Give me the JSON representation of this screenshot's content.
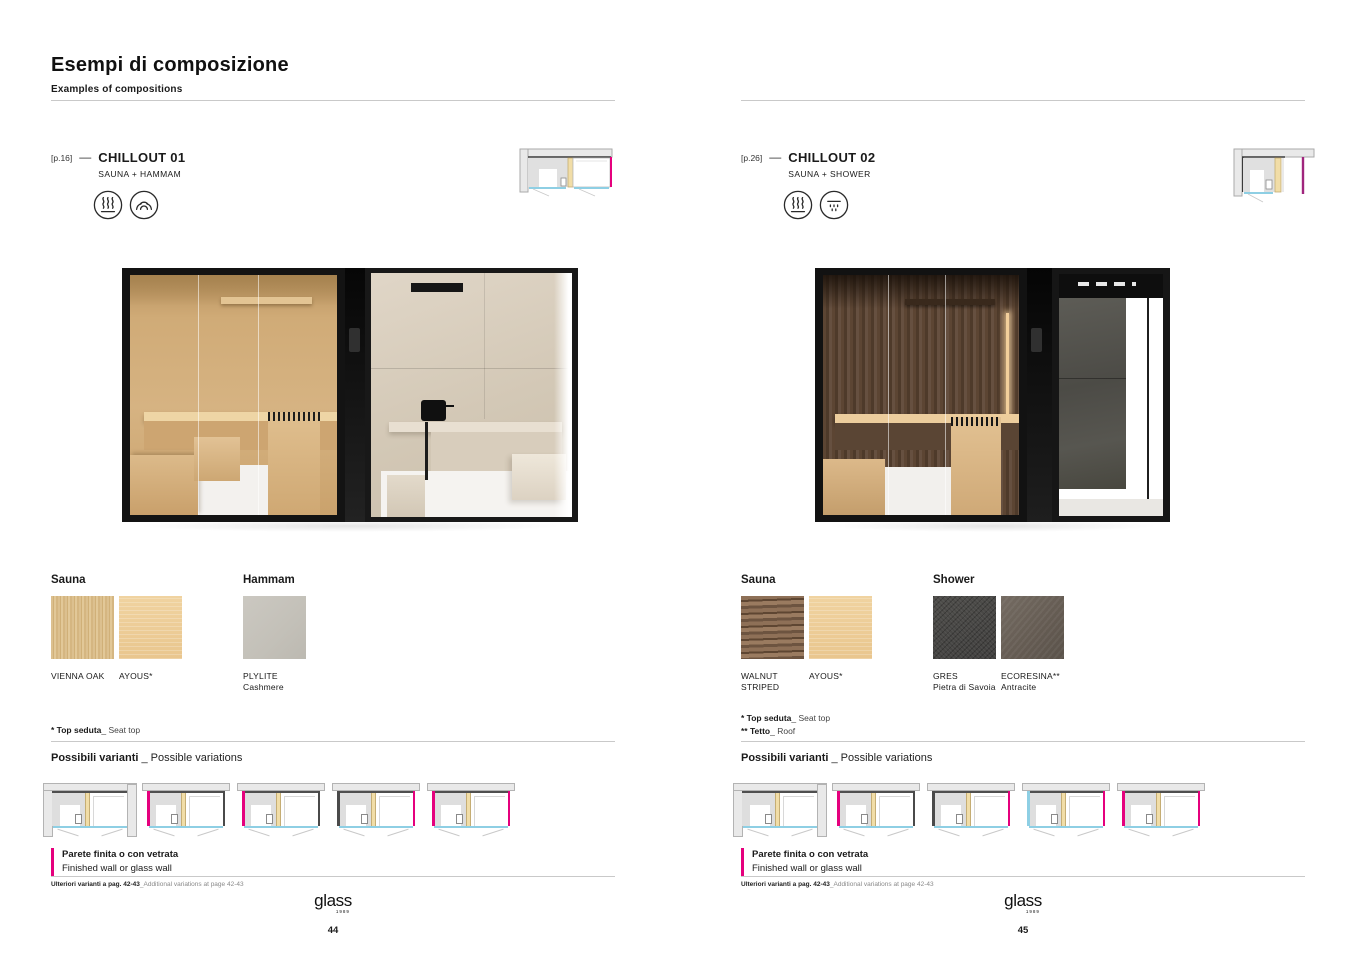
{
  "colors": {
    "accent_pink": "#e5007d",
    "glass_blue": "#8ecfe4",
    "wall_grey": "#e9e9e9",
    "text": "#1a1a1a"
  },
  "header": {
    "title": "Esempi di composizione",
    "subtitle": "Examples of compositions"
  },
  "pages": [
    {
      "page_ref": "[p.16]",
      "dash": "—",
      "product_name": "CHILLOUT 01",
      "product_type": "SAUNA + HAMMAM",
      "icons": [
        "sauna-heat-icon",
        "hammam-steam-icon"
      ],
      "materials": [
        {
          "group": "Sauna",
          "swatches": [
            {
              "name": "VIENNA OAK",
              "sub": "",
              "texture": "vienna-oak"
            },
            {
              "name": "AYOUS*",
              "sub": "",
              "texture": "ayous"
            }
          ]
        },
        {
          "group": "Hammam",
          "swatches": [
            {
              "name": "PLYLITE",
              "sub": "Cashmere",
              "texture": "plylite-cashmere"
            }
          ]
        }
      ],
      "footnotes": [
        {
          "bold": "* Top seduta",
          "rest": "_ Seat top"
        }
      ],
      "variants_title": {
        "bold": "Possibili varianti",
        "rest": " _ Possible variations"
      },
      "variants": [
        "niche",
        "pink-dark",
        "pink-dark",
        "dark-pink",
        "pink-pink"
      ],
      "legend": {
        "line1": "Parete finita o con vetrata",
        "line2": "Finished wall or glass wall"
      },
      "note": {
        "bold": "Ulteriori varianti a pag. 42-43",
        "rest": "_Additional variations at page 42-43"
      },
      "logo": {
        "name": "glass",
        "year": "1989"
      },
      "page_number": "44"
    },
    {
      "page_ref": "[p.26]",
      "dash": "—",
      "product_name": "CHILLOUT 02",
      "product_type": "SAUNA + SHOWER",
      "icons": [
        "sauna-heat-icon",
        "shower-drops-icon"
      ],
      "materials": [
        {
          "group": "Sauna",
          "swatches": [
            {
              "name": "WALNUT STRIPED",
              "sub": "",
              "texture": "walnut-striped"
            },
            {
              "name": "AYOUS*",
              "sub": "",
              "texture": "ayous"
            }
          ]
        },
        {
          "group": "Shower",
          "swatches": [
            {
              "name": "GRES",
              "sub": "Pietra di Savoia",
              "texture": "gres-pietra"
            },
            {
              "name": "ECORESINA**",
              "sub": "Antracite",
              "texture": "ecoresina-antracite"
            }
          ]
        }
      ],
      "footnotes": [
        {
          "bold": "* Top seduta",
          "rest": "_ Seat top"
        },
        {
          "bold": "** Tetto",
          "rest": "_ Roof"
        }
      ],
      "variants_title": {
        "bold": "Possibili varianti",
        "rest": " _ Possible variations"
      },
      "variants": [
        "niche",
        "pink-dark",
        "dark-pink",
        "blue-pink",
        "pink-pink"
      ],
      "legend": {
        "line1": "Parete finita o con vetrata",
        "line2": "Finished wall or glass wall"
      },
      "note": {
        "bold": "Ulteriori varianti a pag. 42-43",
        "rest": "_Additional variations at page 42-43"
      },
      "logo": {
        "name": "glass",
        "year": "1989"
      },
      "page_number": "45"
    }
  ]
}
